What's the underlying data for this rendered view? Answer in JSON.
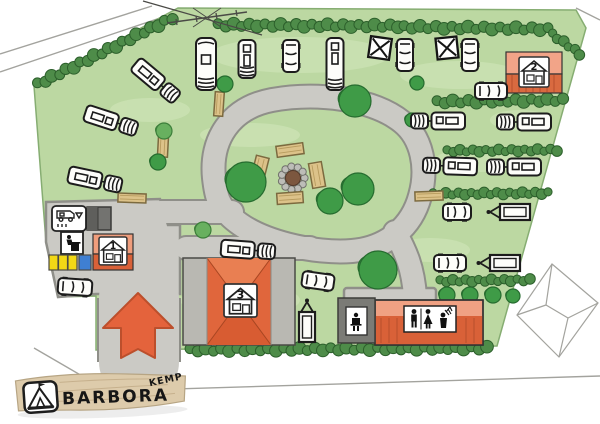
{
  "logo": {
    "name": "BARBORA",
    "suffix": "KEMP"
  },
  "buildings": [
    {
      "id": "reception",
      "label": "1"
    },
    {
      "id": "cabin",
      "label": "2"
    },
    {
      "id": "main-house",
      "label": "3"
    }
  ],
  "palette": {
    "grass": "#bcd8a2",
    "grass_light": "#d3e8bc",
    "hedge": "#4e8c49",
    "tree_dark": "#3f9b47",
    "tree_medium": "#68b05f",
    "road_fill": "#cbcac5",
    "road_edge": "#8f8f89",
    "roof_salmon": "#ef9d7c",
    "roof_red": "#d96138",
    "building3_roof": "#e0663c",
    "building3_wing": "#b9b8b2",
    "shed_dark": "#737370",
    "container_yellow": "#f2d816",
    "container_blue": "#3f7fd2",
    "arrow_orange": "#e4633c",
    "bench_wood": "#dcc289",
    "firepit_soil": "#7c573f",
    "stone_gray": "#bdbdb8",
    "plank_tan": "#ddcbab",
    "vehicle_white": "#fdfdfa",
    "outline_black": "#1c1c1c",
    "pencil_gray": "#a3a39e"
  },
  "map_items": {
    "firepit": {
      "x": 293,
      "y": 178
    },
    "vehicles": [
      {
        "type": "combo",
        "x": 156,
        "y": 81,
        "rot": 220
      },
      {
        "type": "motorhome",
        "x": 206,
        "y": 64,
        "rot": 90
      },
      {
        "type": "caravan",
        "x": 247,
        "y": 59,
        "rot": 90,
        "len": 38
      },
      {
        "type": "car",
        "x": 291,
        "y": 56,
        "rot": 90
      },
      {
        "type": "caravan",
        "x": 335,
        "y": 64,
        "rot": 90,
        "len": 52
      },
      {
        "type": "car",
        "x": 405,
        "y": 55,
        "rot": 90
      },
      {
        "type": "car",
        "x": 470,
        "y": 55,
        "rot": 90
      },
      {
        "type": "car",
        "x": 491,
        "y": 91,
        "rot": 0
      },
      {
        "type": "combo",
        "x": 111,
        "y": 121,
        "rot": 198
      },
      {
        "type": "combo",
        "x": 95,
        "y": 180,
        "rot": 192
      },
      {
        "type": "car",
        "x": 75,
        "y": 287,
        "rot": 4,
        "len": 34
      },
      {
        "type": "combo",
        "x": 248,
        "y": 250,
        "rot": 184
      },
      {
        "type": "car",
        "x": 318,
        "y": 281,
        "rot": 8
      },
      {
        "type": "trailer",
        "x": 307,
        "y": 317,
        "rot": 90
      },
      {
        "type": "combo",
        "x": 438,
        "y": 121,
        "rot": 0
      },
      {
        "type": "combo",
        "x": 524,
        "y": 122,
        "rot": 0
      },
      {
        "type": "combo",
        "x": 450,
        "y": 166,
        "rot": 2
      },
      {
        "type": "combo",
        "x": 514,
        "y": 167,
        "rot": 0
      },
      {
        "type": "car",
        "x": 457,
        "y": 212,
        "rot": 0,
        "len": 28
      },
      {
        "type": "trailer",
        "x": 505,
        "y": 212,
        "rot": 0
      },
      {
        "type": "car",
        "x": 450,
        "y": 263,
        "rot": 0
      },
      {
        "type": "trailer",
        "x": 495,
        "y": 263,
        "rot": 0
      }
    ],
    "tents": [
      {
        "x": 380,
        "y": 48,
        "rot": 8
      },
      {
        "x": 447,
        "y": 48,
        "rot": -6
      }
    ],
    "trees": [
      {
        "x": 164,
        "y": 131,
        "r": 8,
        "shade": "m"
      },
      {
        "x": 158,
        "y": 162,
        "r": 8,
        "shade": "d"
      },
      {
        "x": 225,
        "y": 84,
        "r": 8,
        "shade": "d"
      },
      {
        "x": 355,
        "y": 101,
        "r": 16,
        "shade": "d"
      },
      {
        "x": 417,
        "y": 83,
        "r": 7,
        "shade": "d"
      },
      {
        "x": 412,
        "y": 120,
        "r": 7,
        "shade": "d"
      },
      {
        "x": 246,
        "y": 182,
        "r": 20,
        "shade": "d"
      },
      {
        "x": 330,
        "y": 201,
        "r": 13,
        "shade": "d"
      },
      {
        "x": 358,
        "y": 189,
        "r": 16,
        "shade": "d"
      },
      {
        "x": 378,
        "y": 270,
        "r": 19,
        "shade": "d"
      },
      {
        "x": 203,
        "y": 230,
        "r": 8,
        "shade": "m"
      },
      {
        "x": 447,
        "y": 295,
        "r": 8,
        "shade": "d"
      },
      {
        "x": 470,
        "y": 295,
        "r": 8,
        "shade": "d"
      },
      {
        "x": 493,
        "y": 295,
        "r": 8,
        "shade": "d"
      },
      {
        "x": 513,
        "y": 296,
        "r": 7,
        "shade": "d"
      }
    ],
    "hedges": [
      {
        "x1": 38,
        "y1": 84,
        "x2": 172,
        "y2": 18,
        "r": 6
      },
      {
        "x1": 218,
        "y1": 25,
        "x2": 398,
        "y2": 26,
        "r": 6
      },
      {
        "x1": 404,
        "y1": 27,
        "x2": 548,
        "y2": 29,
        "r": 6
      },
      {
        "x1": 552,
        "y1": 34,
        "x2": 580,
        "y2": 54,
        "r": 5
      },
      {
        "x1": 437,
        "y1": 102,
        "x2": 563,
        "y2": 100,
        "r": 6
      },
      {
        "x1": 447,
        "y1": 151,
        "x2": 557,
        "y2": 150,
        "r": 5
      },
      {
        "x1": 433,
        "y1": 194,
        "x2": 548,
        "y2": 193,
        "r": 5
      },
      {
        "x1": 440,
        "y1": 281,
        "x2": 530,
        "y2": 280,
        "r": 5
      },
      {
        "x1": 190,
        "y1": 350,
        "x2": 487,
        "y2": 348,
        "r": 6
      }
    ],
    "benches": [
      {
        "x": 290,
        "y": 150,
        "w": 27,
        "h": 11,
        "rot": -8
      },
      {
        "x": 260,
        "y": 168,
        "w": 13,
        "h": 23,
        "rot": 14
      },
      {
        "x": 317,
        "y": 175,
        "w": 13,
        "h": 25,
        "rot": -10
      },
      {
        "x": 290,
        "y": 198,
        "w": 26,
        "h": 11,
        "rot": -4
      },
      {
        "x": 132,
        "y": 198,
        "w": 28,
        "h": 9,
        "rot": 2
      },
      {
        "x": 163,
        "y": 146,
        "w": 10,
        "h": 22,
        "rot": 3
      },
      {
        "x": 219,
        "y": 104,
        "w": 9,
        "h": 24,
        "rot": 4
      },
      {
        "x": 429,
        "y": 196,
        "w": 28,
        "h": 9,
        "rot": -2
      }
    ]
  }
}
